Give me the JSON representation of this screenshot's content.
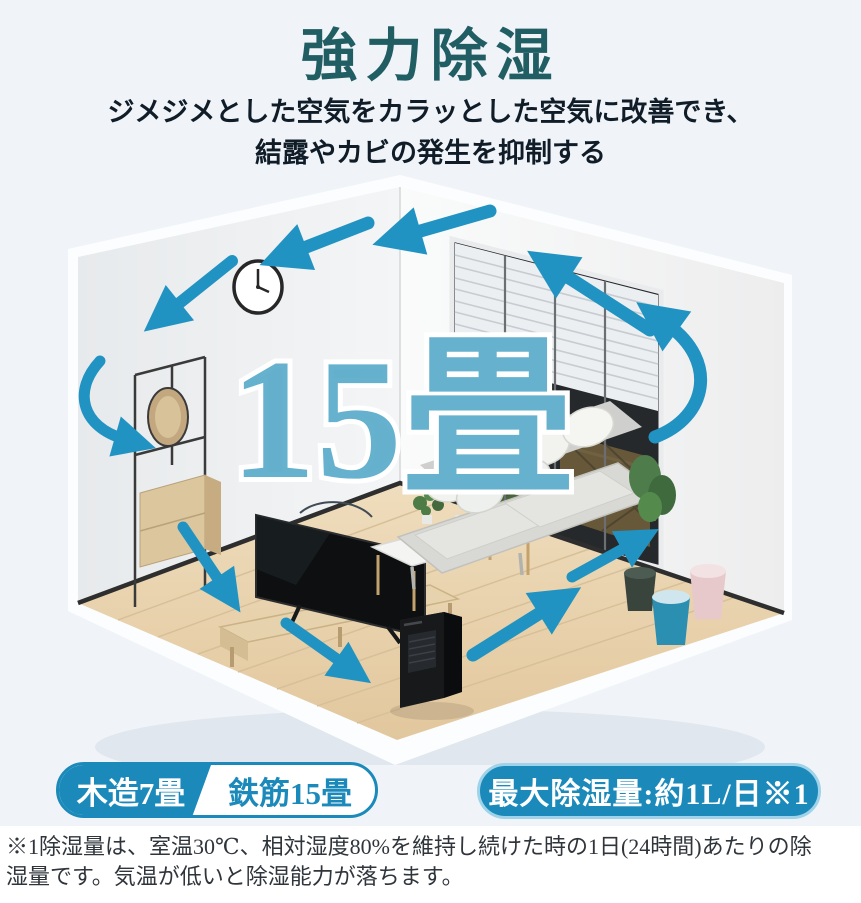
{
  "header": {
    "title": "強力除湿",
    "subtitle_line1": "ジメジメとした空気をカラッとした空気に改善でき、",
    "subtitle_line2": "結露やカビの発生を抑制する"
  },
  "illustration": {
    "size_label": "15畳",
    "depicts": "isometric living room with wall clock, coat rack with mirror, TV, coffee table, sofa, plants, storage bins, window with blinds, black dehumidifier and circulating air-flow arrows"
  },
  "badges": {
    "left_primary": "木造7畳",
    "left_secondary": "鉄筋15畳",
    "right": "最大除湿量:約1L/日※1"
  },
  "footnote": {
    "line1": "※1除湿量は、室温30℃、相対湿度80%を維持し続けた時の1日(24時間)あたりの除",
    "line2": "湿量です。気温が低いと除湿能力が落ちます。"
  },
  "colors": {
    "accent_blue": "#1b8abb",
    "arrow_blue": "#2193c2",
    "title_teal": "#215e63",
    "size_label_fill": "#4aa3c6",
    "floor_wood": "#e9d6b4"
  }
}
